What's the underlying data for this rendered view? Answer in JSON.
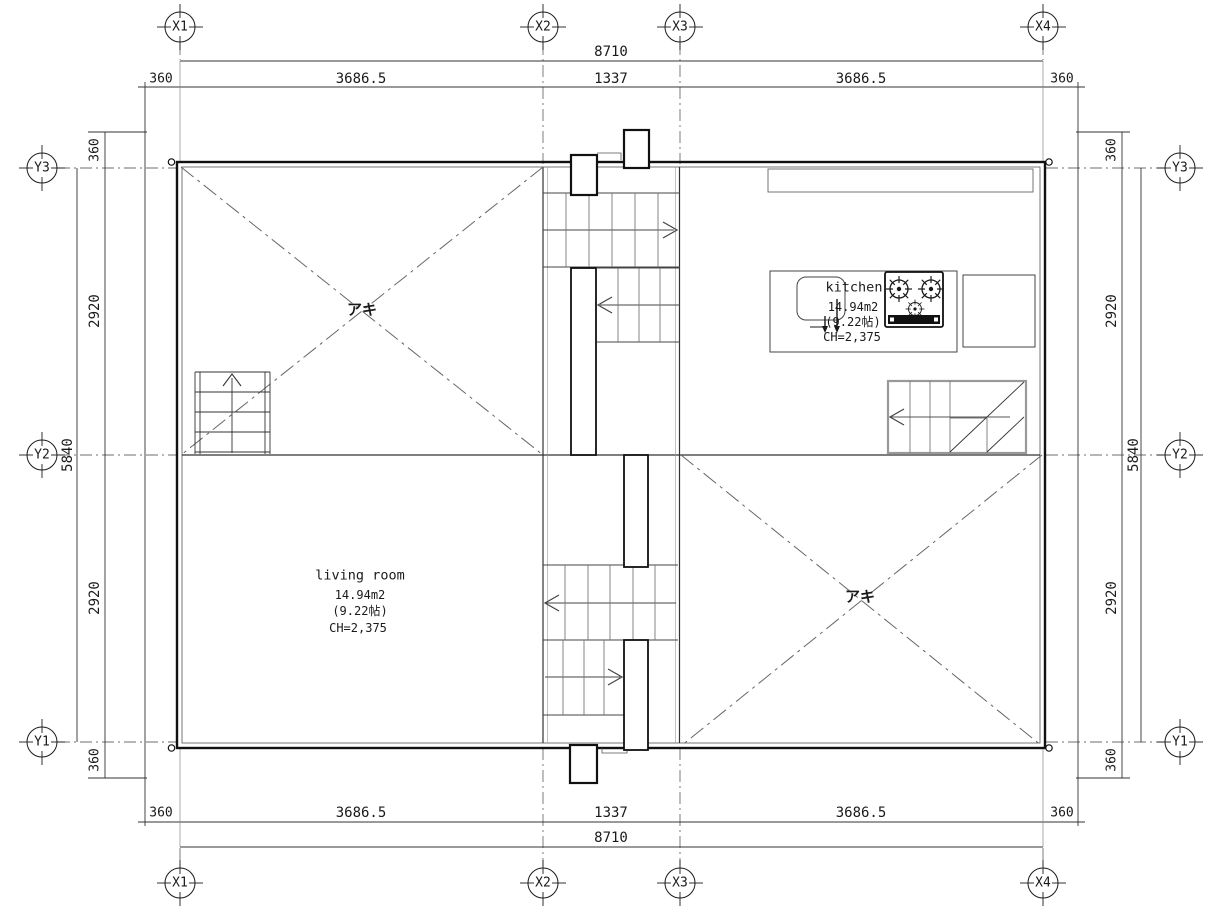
{
  "drawing": {
    "axis_markers": {
      "x": [
        "X1",
        "X2",
        "X3",
        "X4"
      ],
      "y": [
        "Y3",
        "Y2",
        "Y1"
      ]
    },
    "dims": {
      "h_total": "8710",
      "h_segments": [
        "360",
        "3686.5",
        "1337",
        "3686.5",
        "360"
      ],
      "v_total": "5840",
      "v_segments": [
        "360",
        "2920",
        "2920",
        "360"
      ]
    },
    "rooms": {
      "kitchen": {
        "name": "kitchen",
        "area_m2": "14.94m2",
        "area_tatami": "(9.22帖)",
        "ceiling_height": "CH=2,375"
      },
      "living_room": {
        "name": "living room",
        "area_m2": "14.94m2",
        "area_tatami": "(9.22帖)",
        "ceiling_height": "CH=2,375"
      }
    },
    "void_labels": {
      "upper_left": "アキ",
      "lower_right": "アキ"
    },
    "colors": {
      "ink": "#1a1a1a",
      "gray": "#6e6e6e",
      "light": "#999999",
      "bg": "#ffffff"
    }
  }
}
